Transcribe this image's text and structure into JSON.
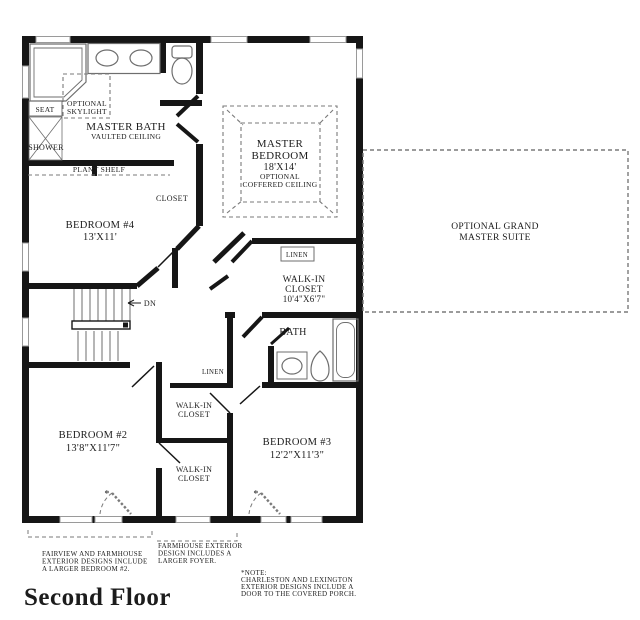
{
  "title": "Second Floor",
  "colors": {
    "wall": "#161616",
    "fixture_line": "#6e6e6e",
    "dashed_line": "#7a7a7a",
    "text": "#1c1c1c"
  },
  "rooms": {
    "master_bath": {
      "name": "MASTER BATH",
      "sub": "VAULTED CEILING"
    },
    "skylight": {
      "l1": "OPTIONAL",
      "l2": "SKYLIGHT"
    },
    "seat": "SEAT",
    "shower": "SHOWER",
    "plant_shelf": "PLANT SHELF",
    "closet": "CLOSET",
    "master_bedroom": {
      "l1": "MASTER",
      "l2": "BEDROOM",
      "dim": "18'X14'",
      "o1": "OPTIONAL",
      "o2": "COFFERED CEILING"
    },
    "optional_suite": {
      "l1": "OPTIONAL GRAND",
      "l2": "MASTER SUITE"
    },
    "bedroom4": {
      "name": "BEDROOM #4",
      "dim": "13'X11'"
    },
    "stairs": {
      "dn": "DN"
    },
    "linen_upper": "LINEN",
    "walk_in_master": {
      "l1": "WALK-IN",
      "l2": "CLOSET",
      "dim": "10'4\"X6'7\""
    },
    "bath": "BATH",
    "linen_lower": "LINEN",
    "walk_in_a": {
      "l1": "WALK-IN",
      "l2": "CLOSET"
    },
    "walk_in_b": {
      "l1": "WALK-IN",
      "l2": "CLOSET"
    },
    "bedroom2": {
      "name": "BEDROOM #2",
      "dim": "13'8\"X11'7\""
    },
    "bedroom3": {
      "name": "BEDROOM #3",
      "dim": "12'2\"X11'3\""
    }
  },
  "marks": {
    "asterisk": "*"
  },
  "notes": {
    "fairview": [
      "FAIRVIEW AND FARMHOUSE",
      "EXTERIOR DESIGNS INCLUDE",
      "A LARGER BEDROOM #2."
    ],
    "farmhouse": [
      "FARMHOUSE EXTERIOR",
      "DESIGN INCLUDES A",
      "LARGER FOYER."
    ],
    "charleston": [
      "*NOTE:",
      "CHARLESTON AND LEXINGTON",
      "EXTERIOR DESIGNS INCLUDE A",
      "DOOR TO THE COVERED PORCH."
    ]
  }
}
